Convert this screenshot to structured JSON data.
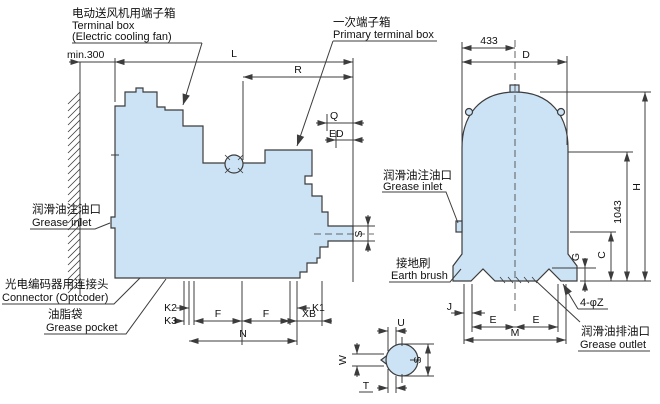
{
  "colors": {
    "body_fill": "#cce3f5",
    "line": "#3c3c3c",
    "text": "#111111",
    "background": "#ffffff"
  },
  "callouts": {
    "fan_terminal_box": {
      "cn": "电动送风机用端子箱",
      "en": "Terminal box",
      "en2": "(Electric cooling fan)"
    },
    "primary_terminal_box": {
      "cn": "一次端子箱",
      "en": "Primary terminal box"
    },
    "grease_inlet_left": {
      "cn": "润滑油注油口",
      "en": "Grease inlet"
    },
    "connector_optcoder": {
      "cn": "光电编码器用连接头",
      "en": "Connector (Optcoder)"
    },
    "grease_pocket": {
      "cn": "油脂袋",
      "en": "Grease pocket"
    },
    "grease_inlet_right": {
      "cn": "润滑油注油口",
      "en": "Grease inlet"
    },
    "earth_brush": {
      "cn": "接地刷",
      "en": "Earth brush"
    },
    "grease_outlet": {
      "cn": "润滑油排油口",
      "en": "Grease outlet"
    },
    "foot_holes": "4-φZ"
  },
  "dimensions": {
    "wall_clearance": "min.300",
    "L": "L",
    "R": "R",
    "Q": "Q",
    "ED": "ED",
    "S_shaft_side": "S",
    "K2": "K2",
    "K3": "K3",
    "K1": "K1",
    "F_left": "F",
    "F_right": "F",
    "N": "N",
    "XB": "XB",
    "top_width": "433",
    "D": "D",
    "H": "H",
    "total_height": "1043",
    "C": "C",
    "G": "G",
    "J": "J",
    "E_left": "E",
    "E_right": "E",
    "M": "M",
    "U": "U",
    "W": "W",
    "T": "T",
    "S_shaft_detail": "S"
  }
}
